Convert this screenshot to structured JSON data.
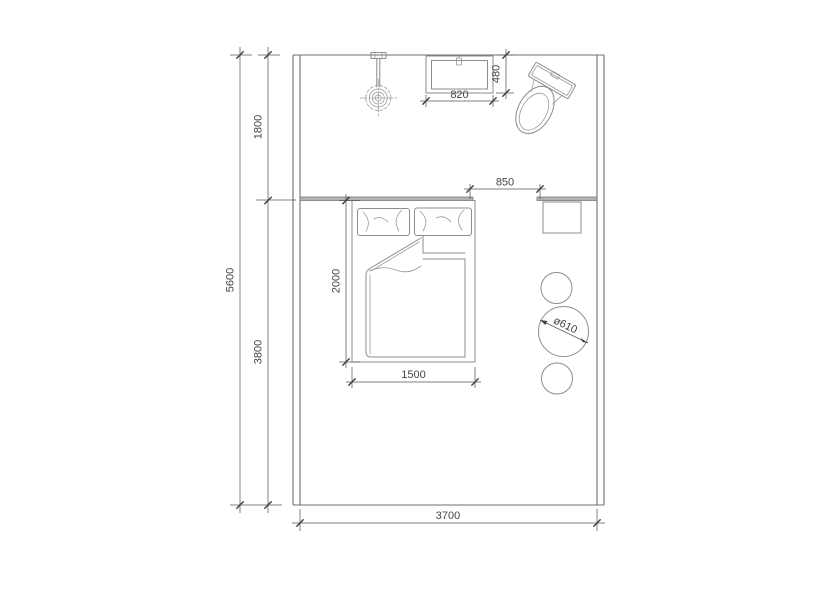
{
  "colors": {
    "background": "#ffffff",
    "wall_line": "#6f6f6f",
    "furniture_line": "#8d8d8d",
    "dimension_line": "#5a5a5a",
    "text": "#454545",
    "partition_fill": "#b2b2b2"
  },
  "dimensions": {
    "total_depth": "5600",
    "upper_zone_depth": "1800",
    "lower_zone_depth": "3800",
    "room_width": "3700",
    "basin_width": "820",
    "basin_depth": "480",
    "opening_width": "850",
    "bed_length": "2000",
    "bed_width": "1500",
    "table_diameter": "ø610"
  },
  "fixtures": {
    "shower": "wall-mounted shower fixture",
    "basin": "washbasin 820x480",
    "toilet": "toilet",
    "bed": "double bed 1500x2000",
    "nightstand": "bedside table",
    "stool_top": "stool",
    "round_table": "round table ø610",
    "stool_bottom": "stool"
  }
}
